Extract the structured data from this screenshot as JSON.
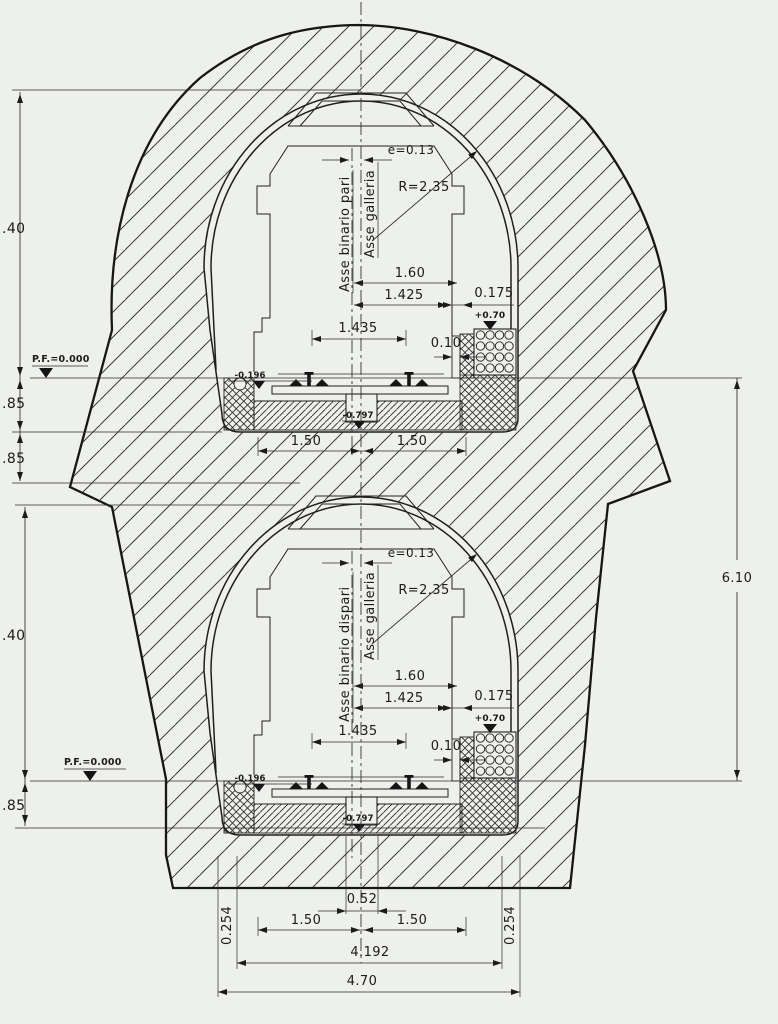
{
  "drawing": {
    "paper_color": "#eef0ec",
    "line_color": "#1f1f1f"
  },
  "labels": {
    "pf_datum": "P.F.=0.000",
    "axis_track_upper": "Asse binario pari",
    "axis_track_lower": "Asse binario dispari",
    "axis_tunnel": "Asse galleria",
    "eccentricity": "e=0.13",
    "radius": "R=2.35",
    "dim_160": "1.60",
    "dim_1425": "1.425",
    "dim_1435": "1.435",
    "dim_0175": "0.175",
    "dim_010": "0.10",
    "level_curb": "+0.70",
    "level_rail": "-0.196",
    "level_invert": "-0.797",
    "dim_150": "1.50",
    "dim_040": ".40",
    "dim_085": ".85",
    "dim_610": "6.10",
    "dim_052": "0.52",
    "dim_0254": "0.254",
    "dim_4192": "4.192",
    "dim_470": "4.70"
  }
}
